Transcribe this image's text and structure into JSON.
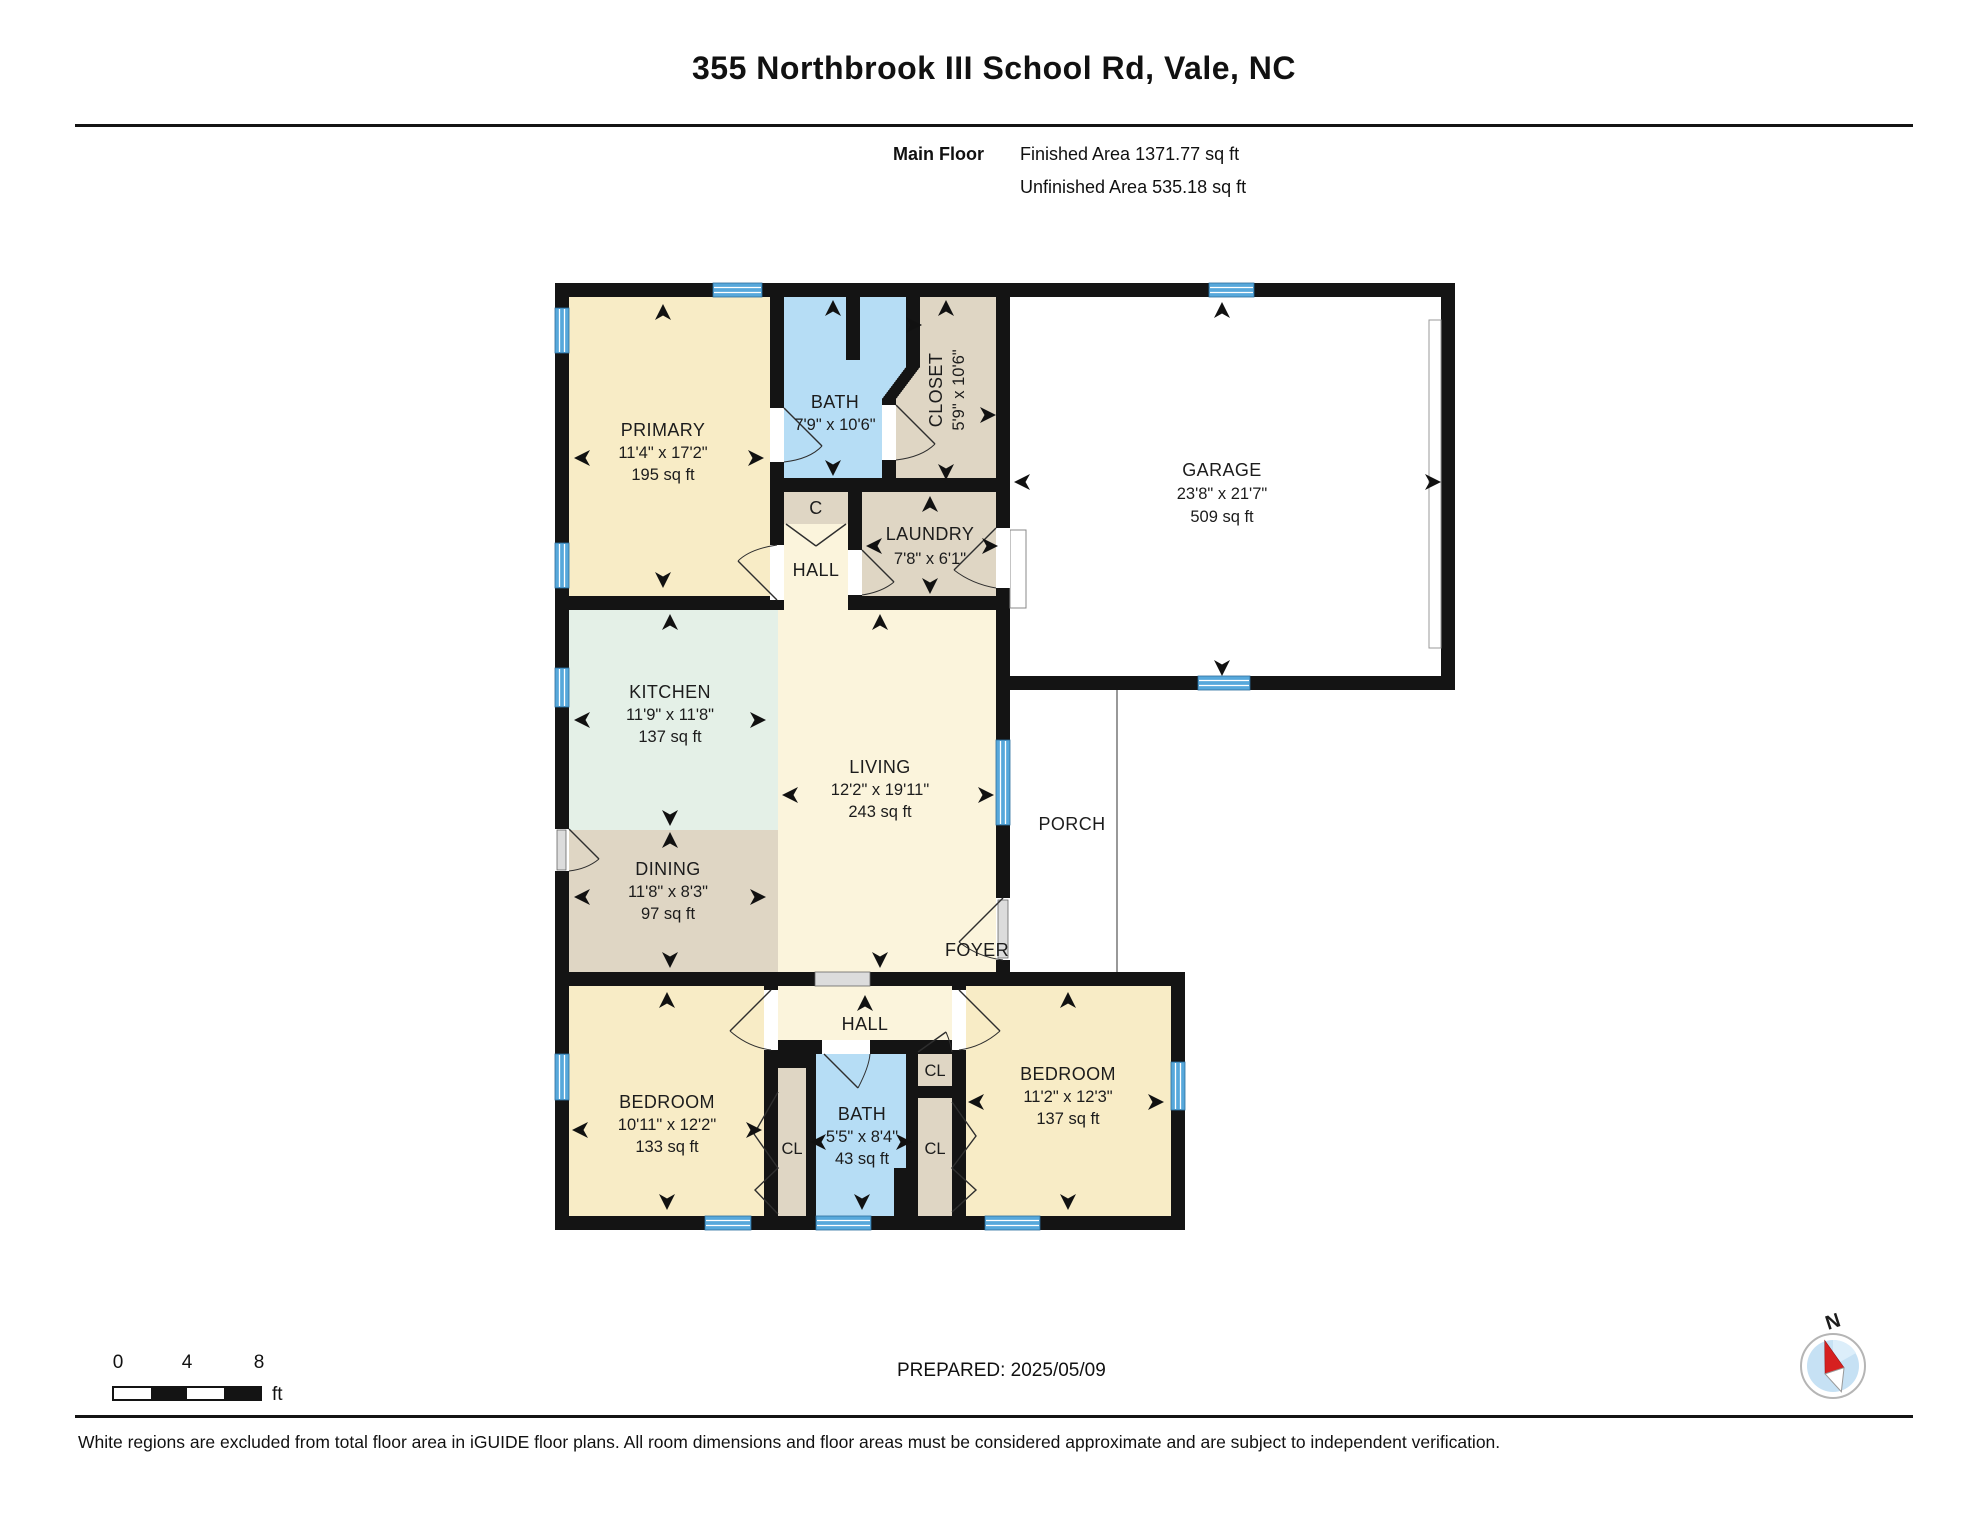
{
  "header": {
    "title": "355 Northbrook III School Rd, Vale, NC",
    "floor_label": "Main Floor",
    "finished_area": "Finished Area 1371.77 sq ft",
    "unfinished_area": "Unfinished Area 535.18 sq ft"
  },
  "rooms": {
    "primary": {
      "name": "PRIMARY",
      "dims": "11'4\" x 17'2\"",
      "area": "195 sq ft"
    },
    "bath1": {
      "name": "BATH",
      "dims": "7'9\" x 10'6\""
    },
    "closet": {
      "name": "CLOSET",
      "dims": "5'9\" x 10'6\""
    },
    "closet_c": {
      "name": "C"
    },
    "hall1": {
      "name": "HALL"
    },
    "laundry": {
      "name": "LAUNDRY",
      "dims": "7'8\" x 6'1\""
    },
    "garage": {
      "name": "GARAGE",
      "dims": "23'8\" x 21'7\"",
      "area": "509 sq ft"
    },
    "kitchen": {
      "name": "KITCHEN",
      "dims": "11'9\" x 11'8\"",
      "area": "137 sq ft"
    },
    "living": {
      "name": "LIVING",
      "dims": "12'2\" x 19'11\"",
      "area": "243 sq ft"
    },
    "dining": {
      "name": "DINING",
      "dims": "11'8\" x 8'3\"",
      "area": "97 sq ft"
    },
    "porch": {
      "name": "PORCH"
    },
    "foyer": {
      "name": "FOYER"
    },
    "hall2": {
      "name": "HALL"
    },
    "bedroom_left": {
      "name": "BEDROOM",
      "dims": "10'11\" x 12'2\"",
      "area": "133 sq ft"
    },
    "bath2": {
      "name": "BATH",
      "dims": "5'5\" x 8'4\"",
      "area": "43 sq ft"
    },
    "cl_left": {
      "name": "CL"
    },
    "cl_top": {
      "name": "CL"
    },
    "cl_bottom": {
      "name": "CL"
    },
    "bedroom_right": {
      "name": "BEDROOM",
      "dims": "11'2\" x 12'3\"",
      "area": "137 sq ft"
    }
  },
  "scale_bar": {
    "tick0": "0",
    "tick4": "4",
    "tick8": "8",
    "unit": "ft"
  },
  "compass": {
    "north_label": "N"
  },
  "footer": {
    "prepared": "PREPARED: 2025/05/09",
    "disclaimer": "White regions are excluded from total floor area in iGUIDE floor plans. All room dimensions and floor areas must be considered approximate and are subject to independent verification."
  },
  "colors": {
    "wall": "#141414",
    "room-cream": "#F8ECC6",
    "room-cream-light": "#FBF4DC",
    "room-mint": "#E4F0E7",
    "room-tan": "#DFD6C4",
    "room-blue": "#B6DDF5",
    "window-blue": "#57A8DB",
    "door-gray": "#DCDCDC",
    "compass-red": "#D62020",
    "compass-blue": "#C6E1F4"
  }
}
